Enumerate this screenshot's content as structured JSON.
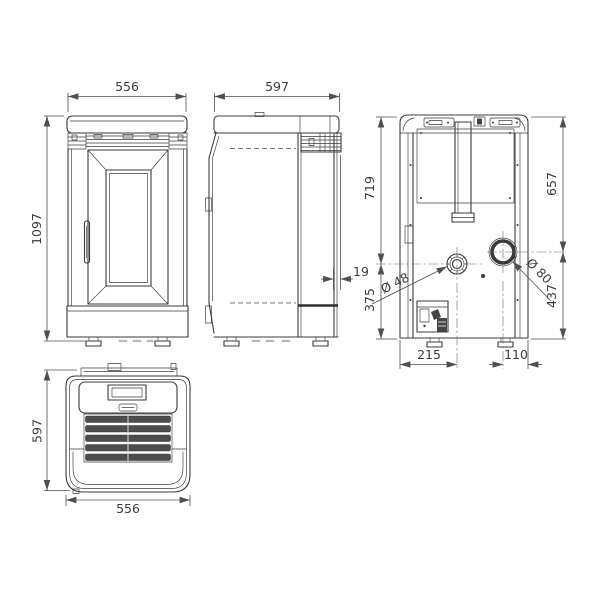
{
  "views": {
    "front": {
      "width": "556",
      "height": "1097"
    },
    "side": {
      "depth": "597",
      "rear_grille_offset": "19"
    },
    "back": {
      "upper_left": "719",
      "lower_left": "375",
      "upper_right": "657",
      "lower_right": "437",
      "bottom_left": "215",
      "bottom_right": "110",
      "air_intake_diameter": "Ø 48",
      "flue_outlet_diameter": "Ø 80"
    },
    "top": {
      "depth": "597",
      "width": "556"
    }
  },
  "colors": {
    "line": "#3b3b3b",
    "dimension": "#4f4f4f",
    "text": "#3c3c3c",
    "slat_fill": "#4c4c4c",
    "background": "#ffffff"
  }
}
